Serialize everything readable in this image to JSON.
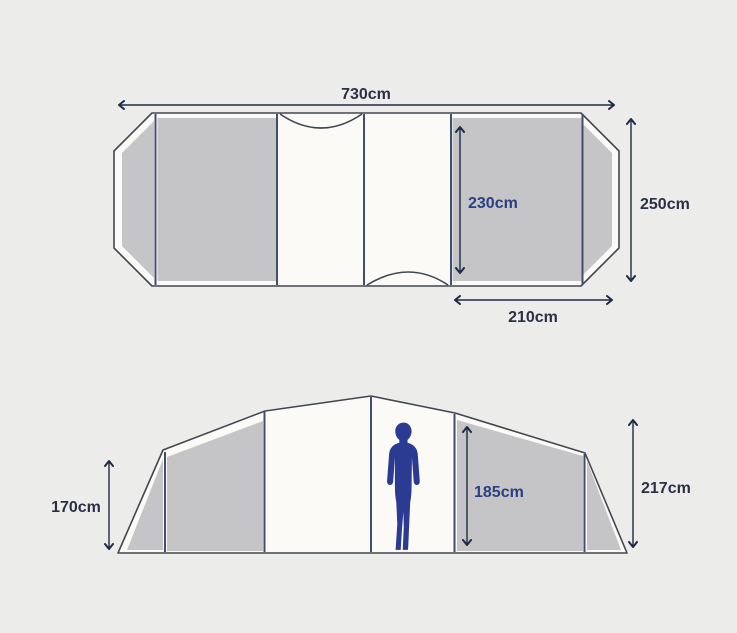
{
  "diagram": {
    "subject": "tent dimensions, floor plan and side elevation"
  },
  "colors": {
    "background": "#ecedeb",
    "panel_gray": "#c5c5c7",
    "canvas_white": "#fbfaf7",
    "outline_dark": "#43464f",
    "divider_navy": "#3f4f70",
    "dimension_navy": "#1f2a44",
    "label_dark": "#2a3145",
    "label_blue": "#2a4080",
    "figure_navy": "#2b3b92"
  },
  "floor_plan": {
    "overall_width": "730cm",
    "overall_depth": "250cm",
    "bedroom_depth": "230cm",
    "bedroom_width": "210cm"
  },
  "elevation": {
    "side_height": "170cm",
    "interior_height": "185cm",
    "peak_height": "217cm"
  }
}
